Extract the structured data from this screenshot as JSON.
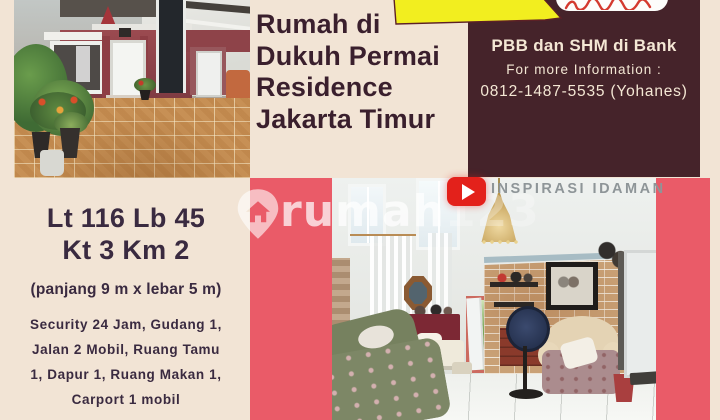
{
  "flyer": {
    "title_lines": [
      "Rumah di",
      "Dukuh Permai",
      "Residence",
      "Jakarta Timur"
    ],
    "contact": {
      "heading": "PBB dan SHM di Bank",
      "info_label": "For more Information :",
      "phone": "0812-1487-5535 (Yohanes)"
    },
    "specs": {
      "line1": "Lt 116 Lb 45",
      "line2": "Kt 3 Km 2",
      "dimensions": "(panjang 9 m x lebar 5 m)",
      "features": [
        "Security 24 Jam, Gudang 1,",
        "Jalan 2 Mobil, Ruang Tamu",
        "1, Dapur 1, Ruang Makan 1,",
        "Carport 1 mobil"
      ]
    },
    "watermark": {
      "brand_main": "rumah",
      "brand_suffix": "123"
    },
    "video_overlay": {
      "channel": "INSPIRASI IDAMAN",
      "play_icon": "youtube-play"
    },
    "colors": {
      "canvas": "#f2e4d5",
      "panel": "#45232a",
      "panel_text": "#f4e7d4",
      "title_text": "#3a1f2d",
      "specs_text": "#3a2a40",
      "stripe_red": "#ea5b68",
      "ribbon_yellow": "#f2ee1f",
      "youtube_red": "#e3211b"
    }
  }
}
